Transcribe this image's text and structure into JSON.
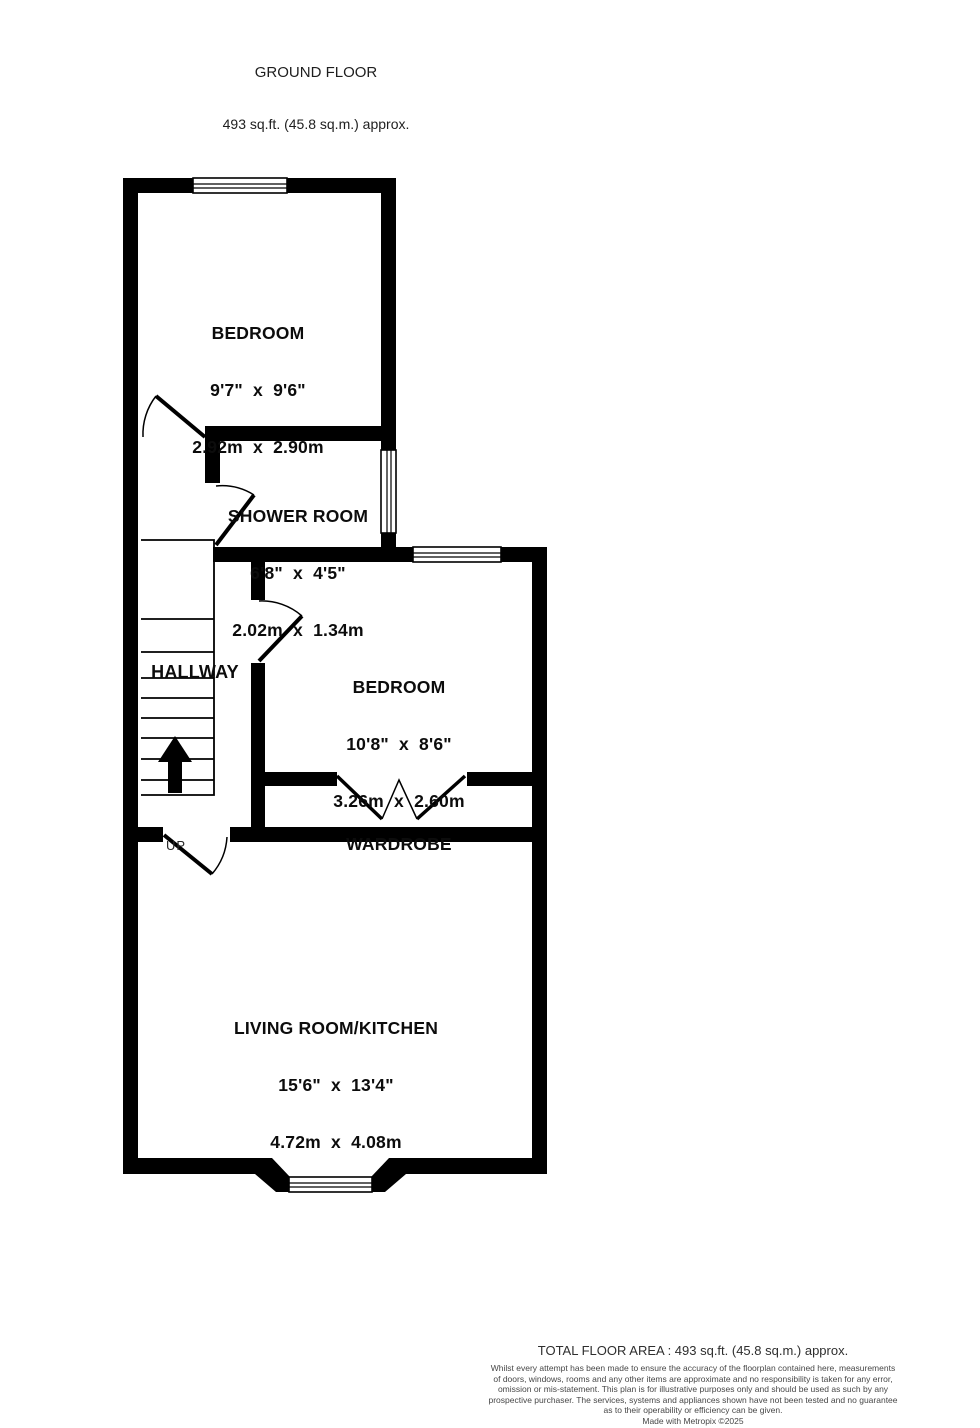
{
  "plan": {
    "title": "GROUND FLOOR",
    "subtitle": "493 sq.ft. (45.8 sq.m.) approx.",
    "rooms": {
      "bedroom1": {
        "name": "BEDROOM",
        "imperial": "9'7\"  x  9'6\"",
        "metric": "2.92m  x  2.90m"
      },
      "shower": {
        "name": "SHOWER ROOM",
        "imperial": "6'8\"  x  4'5\"",
        "metric": "2.02m  x  1.34m"
      },
      "hallway": {
        "name": "HALLWAY"
      },
      "bedroom2": {
        "name": "BEDROOM",
        "imperial": "10'8\"  x  8'6\"",
        "metric": "3.26m  x  2.60m"
      },
      "wardrobe": {
        "name": "WARDROBE"
      },
      "living": {
        "name": "LIVING ROOM/KITCHEN",
        "imperial": "15'6\"  x  13'4\"",
        "metric": "4.72m  x  4.08m"
      }
    },
    "stairs": {
      "up_label": "UP"
    },
    "colors": {
      "wall": "#000000",
      "label_text": "#0c0c0c",
      "footer_text": "#474747"
    }
  },
  "footer": {
    "total_area": "TOTAL FLOOR AREA : 493 sq.ft. (45.8 sq.m.) approx.",
    "disclaimer_lines": [
      "Whilst every attempt has been made to ensure the accuracy of the floorplan contained here, measurements",
      "of doors, windows, rooms and any other items are approximate and no responsibility is taken for any error,",
      "omission or mis-statement. This plan is for illustrative purposes only and should be used as such by any",
      "prospective purchaser. The services, systems and appliances shown have not been tested and no guarantee",
      "as to their operability or efficiency can be given."
    ],
    "credit": "Made with Metropix ©2025"
  }
}
